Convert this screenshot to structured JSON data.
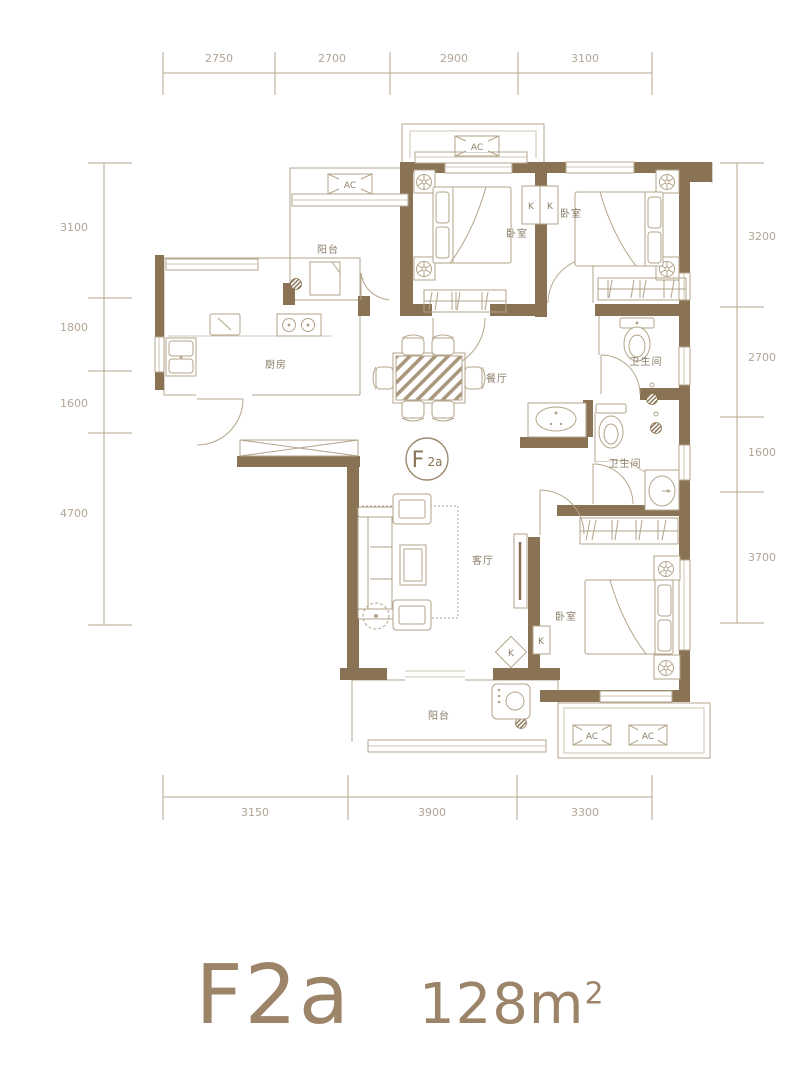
{
  "dimensions": {
    "top": [
      "2750",
      "2700",
      "2900",
      "3100"
    ],
    "left": [
      "3100",
      "1800",
      "1600",
      "4700"
    ],
    "right": [
      "3200",
      "2700",
      "1600",
      "3700"
    ],
    "bottom": [
      "3150",
      "3900",
      "3300"
    ]
  },
  "plan": {
    "rooms": {
      "balcony_top": "阳台",
      "bedroom_1": "卧室",
      "bedroom_2": "卧室",
      "kitchen": "厨房",
      "dining": "餐厅",
      "bathroom_1": "卫生间",
      "bathroom_2": "卫生间",
      "living": "客厅",
      "bedroom_3": "卧室",
      "balcony_bottom": "阳台"
    },
    "markers": {
      "ac": "AC",
      "k": "K"
    },
    "unit_circle": {
      "main": "F",
      "sub": "2a"
    }
  },
  "title": {
    "model": "F2a",
    "area": "128m",
    "area_sup": "2"
  },
  "colors": {
    "wall": "#8a7355",
    "line": "#b5a68c",
    "dim_text": "#b2a496",
    "title_text": "#9c8468"
  }
}
